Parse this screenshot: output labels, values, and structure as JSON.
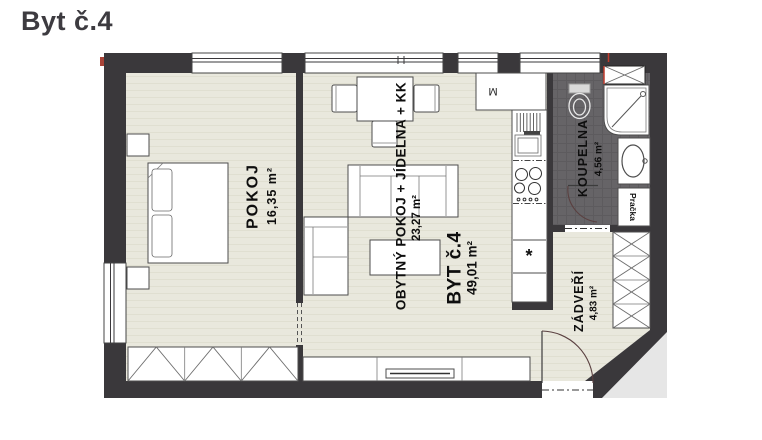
{
  "title": "Byt č.4",
  "plan": {
    "rooms": [
      {
        "id": "pokoj",
        "name": "POKOJ",
        "area": "16,35 m²"
      },
      {
        "id": "obytny-pokoj",
        "name": "OBYTNÝ POKOJ + JÍDELNA + KK",
        "area": "23,27 m²"
      },
      {
        "id": "koupelna",
        "name": "KOUPELNA",
        "area": "4,56 m²"
      },
      {
        "id": "zadveri",
        "name": "ZÁDVEŘÍ",
        "area": "4,83 m²"
      }
    ],
    "apartment": {
      "name": "BYT č.4",
      "area": "49,01 m²"
    },
    "appliances": {
      "washer": "Pračka",
      "m_label": "M",
      "fridge_symbol": "*"
    },
    "colors": {
      "wall": "#3a383b",
      "floor": "#e9e8dd",
      "bath_floor": "#666467",
      "red_mark": "#c03a2c",
      "furniture": "#ffffff"
    }
  }
}
